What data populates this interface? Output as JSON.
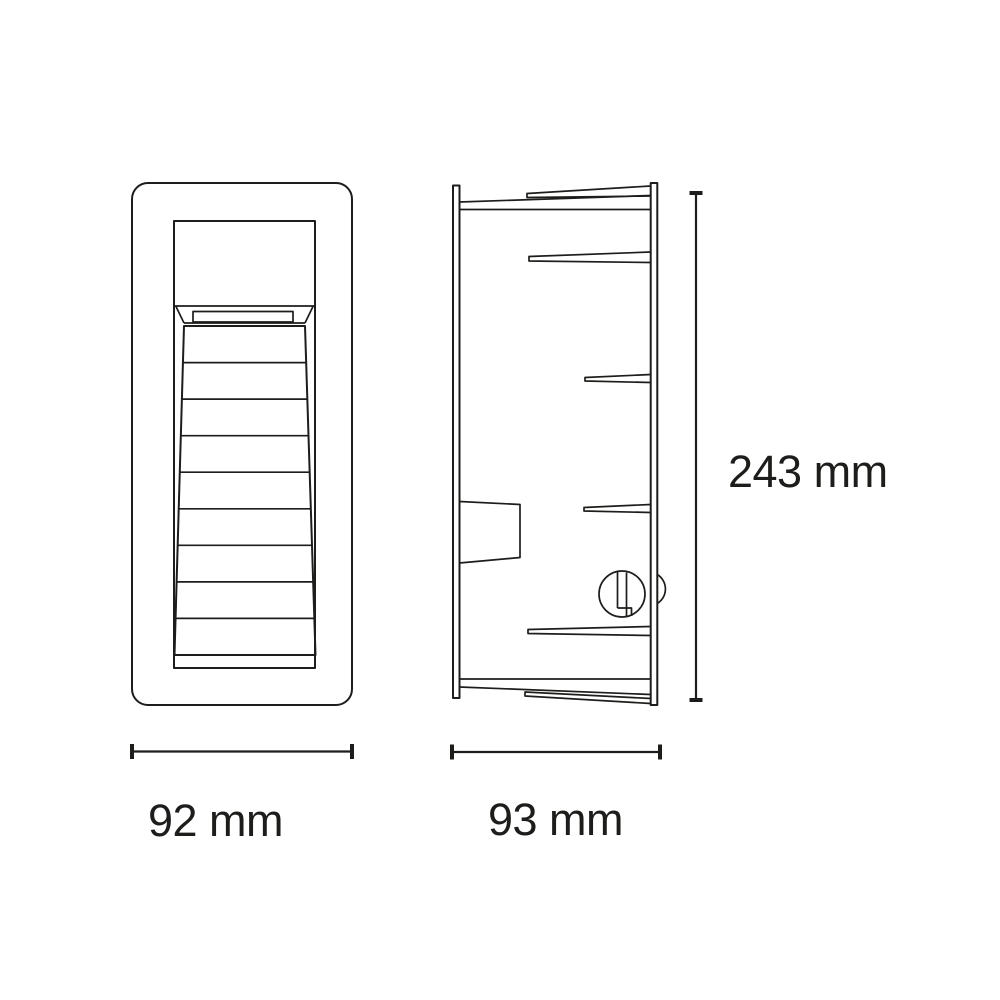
{
  "canvas": {
    "background_color": "#ffffff",
    "line_color": "#1d1d1b",
    "text_color": "#1d1d1b"
  },
  "drawing": {
    "type": "product-dimension-diagram",
    "views": {
      "front_view": {
        "name": "front view of recessed louvered fixture"
      },
      "side_view": {
        "name": "side profile of flush-mount housing"
      }
    },
    "dimensions": {
      "front_width": {
        "label": "92 mm",
        "value": 92,
        "unit": "mm",
        "orientation": "horizontal"
      },
      "side_depth": {
        "label": "93 mm",
        "value": 93,
        "unit": "mm",
        "orientation": "horizontal"
      },
      "height": {
        "label": "243 mm",
        "value": 243,
        "unit": "mm",
        "orientation": "vertical"
      }
    }
  }
}
